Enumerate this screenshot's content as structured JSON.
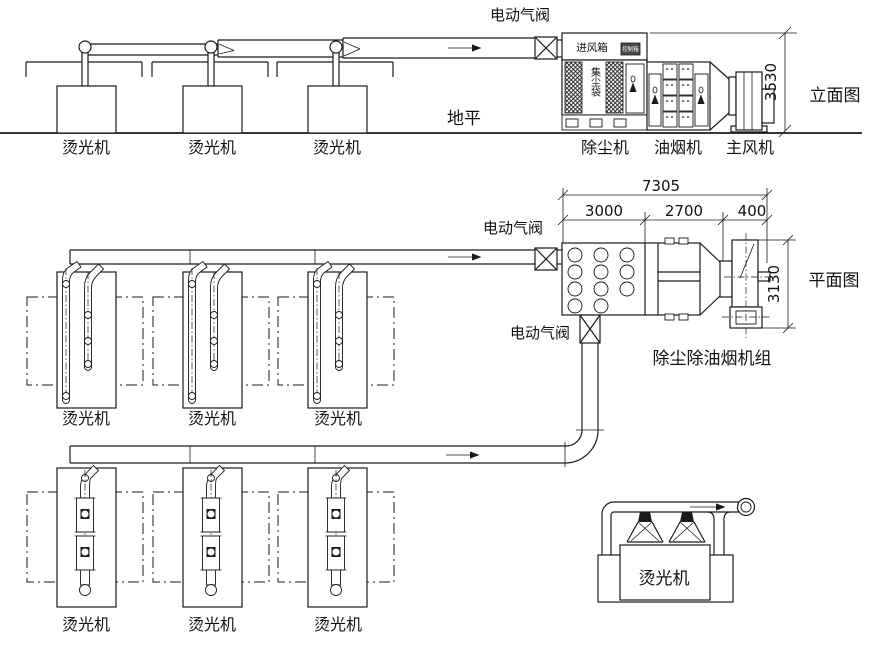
{
  "colors": {
    "line": "#1a1a1a",
    "background": "#ffffff",
    "hood_fill": "#222222"
  },
  "elevation": {
    "view_label": "立面图",
    "valve_label": "电动气阀",
    "ground_label": "地平",
    "height_dim": "3530",
    "inlet_box_label": "进风箱",
    "inlet_panel_label": "控制箱",
    "dust_bag_label": "集尘袋",
    "machines": [
      "烫光机",
      "烫光机",
      "烫光机"
    ],
    "equipment": [
      "除尘机",
      "油烟机",
      "主风机"
    ]
  },
  "plan": {
    "view_label": "平面图",
    "unit_label": "除尘除油烟机组",
    "valve_top_label": "电动气阀",
    "valve_bottom_label": "电动气阀",
    "dim_total": "7305",
    "dim_seg1": "3000",
    "dim_seg2": "2700",
    "dim_seg3": "400",
    "dim_height": "3130",
    "machines_row1": [
      "烫光机",
      "烫光机",
      "烫光机"
    ],
    "machines_row2": [
      "烫光机",
      "烫光机",
      "烫光机"
    ]
  },
  "detail": {
    "machine_label": "烫光机"
  }
}
